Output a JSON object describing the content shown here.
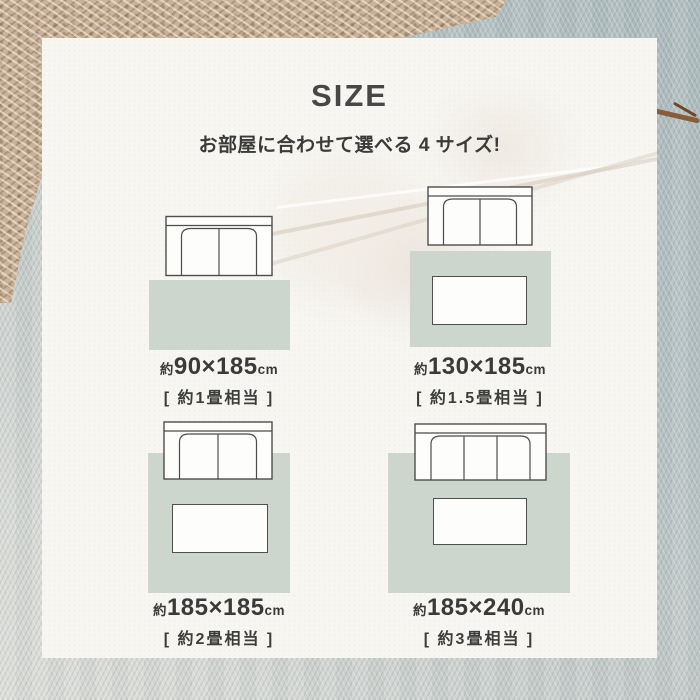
{
  "header": {
    "title": "SIZE",
    "subtitle": "お部屋に合わせて選べる 4 サイズ!"
  },
  "sizes": [
    {
      "prefix": "約",
      "dimensions": "90×185",
      "unit": "cm",
      "tatami": "[ 約1畳相当 ]",
      "sofa_seats": 2,
      "table_shown": false,
      "sofa_on_rug": false
    },
    {
      "prefix": "約",
      "dimensions": "130×185",
      "unit": "cm",
      "tatami": "[ 約1.5畳相当 ]",
      "sofa_seats": 2,
      "table_shown": true,
      "sofa_on_rug": false
    },
    {
      "prefix": "約",
      "dimensions": "185×185",
      "unit": "cm",
      "tatami": "[ 約2畳相当 ]",
      "sofa_seats": 2,
      "table_shown": true,
      "sofa_on_rug": true
    },
    {
      "prefix": "約",
      "dimensions": "185×240",
      "unit": "cm",
      "tatami": "[ 約3畳相当 ]",
      "sofa_seats": 3,
      "table_shown": true,
      "sofa_on_rug": true
    }
  ],
  "colors": {
    "rug": "#ccd6cd",
    "card_background": "#f7f6f2",
    "heading_text": "#474747",
    "label_text": "#3a3a3a",
    "diagram_outline": "#4d4d4d",
    "knit_blanket": "#c9b299",
    "fabric_background": "#b7c3c4"
  }
}
